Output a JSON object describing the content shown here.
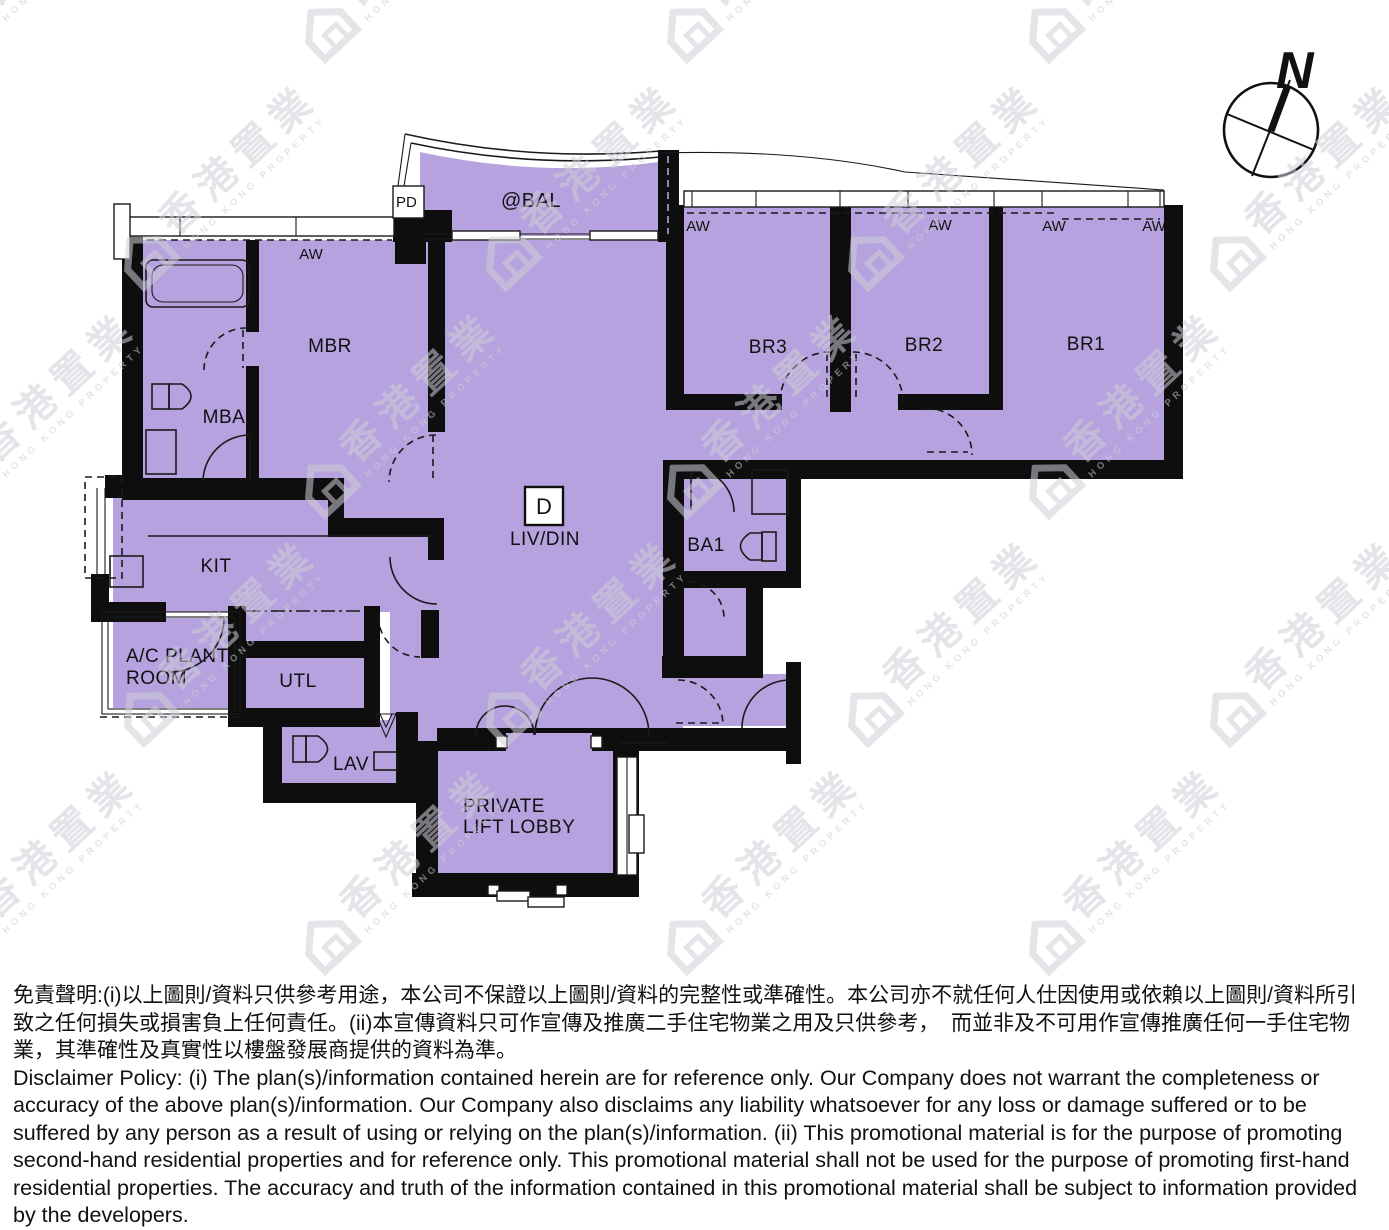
{
  "colors": {
    "room_fill": "#b6a2de",
    "wall": "#0e0e0e",
    "watermark": "#cfced8",
    "text": "#111111",
    "background": "#ffffff"
  },
  "floorplan": {
    "unit_box_label": "D",
    "labels": {
      "mbr": "MBR",
      "mba": "MBA",
      "br1": "BR1",
      "br2": "BR2",
      "br3": "BR3",
      "kit": "KIT",
      "utl": "UTL",
      "lav": "LAV",
      "ba1": "BA1",
      "liv": "LIV/DIN",
      "bal": "@BAL",
      "pd": "PD",
      "ac_line1": "A/C PLANT",
      "ac_line2": "ROOM",
      "lobby_line1": "PRIVATE",
      "lobby_line2": "LIFT LOBBY"
    },
    "window_label": "AW",
    "compass_label": "N"
  },
  "watermark": {
    "cn": "香港置業",
    "en": "HONG KONG PROPERTY"
  },
  "disclaimer": {
    "chinese": "免責聲明:(i)以上圖則/資料只供參考用途，本公司不保證以上圖則/資料的完整性或準確性。本公司亦不就任何人仕因使用或依賴以上圖則/資料所引致之任何損失或損害負上任何責任。(ii)本宣傳資料只可作宣傳及推廣二手住宅物業之用及只供參考，  而並非及不可用作宣傳推廣任何一手住宅物業，其準確性及真實性以樓盤發展商提供的資料為準。",
    "english": "Disclaimer Policy: (i) The plan(s)/information contained herein are for reference only. Our Company does not warrant the completeness or accuracy of the above plan(s)/information. Our Company also disclaims any liability whatsoever for any loss or damage suffered or to be suffered by any person as a result of using or relying on the plan(s)/information. (ii) This promotional material is for the purpose of promoting second-hand residential properties and for reference only. This promotional material shall not be used for the purpose of promoting first-hand residential properties. The accuracy and truth of the information contained in this promotional material shall be subject to information provided by the developers."
  }
}
